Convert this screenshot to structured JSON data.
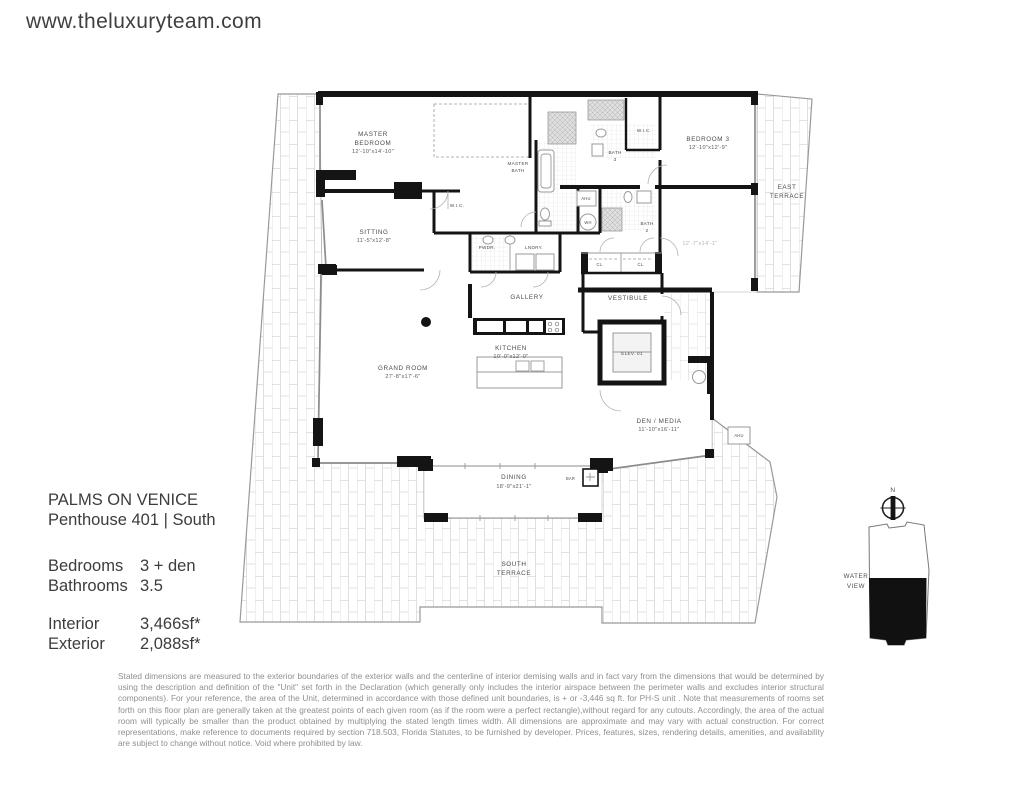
{
  "site": {
    "url": "www.theluxuryteam.com"
  },
  "listing": {
    "title": "PALMS ON VENICE",
    "subtitle": "Penthouse 401 | South",
    "specs": [
      {
        "label": "Bedrooms",
        "value": "3 + den"
      },
      {
        "label": "Bathrooms",
        "value": "3.5"
      },
      {
        "label": "Interior",
        "value": "3,466sf*"
      },
      {
        "label": "Exterior",
        "value": "2,088sf*"
      }
    ]
  },
  "floorplan": {
    "rooms": {
      "master_bedroom": {
        "l1": "MASTER",
        "l2": "BEDROOM",
        "dim": "12'-10\"x14'-10\""
      },
      "sitting": {
        "l1": "SITTING",
        "dim": "11'-5\"x12'-8\""
      },
      "master_wic": {
        "l1": "W.I.C."
      },
      "master_bath": {
        "l1": "MASTER",
        "l2": "BATH"
      },
      "pwdr": {
        "l1": "PWDR."
      },
      "lndry": {
        "l1": "LNDRY."
      },
      "gallery": {
        "l1": "GALLERY"
      },
      "kitchen": {
        "l1": "KITCHEN",
        "dim": "10'-0\"x12'-0\""
      },
      "grand_room": {
        "l1": "GRAND ROOM",
        "dim": "27'-8\"x17'-6\""
      },
      "dining": {
        "l1": "DINING",
        "dim": "18'-9\"x21'-1\""
      },
      "bar": {
        "l1": "BAR"
      },
      "south_terrace": {
        "l1": "SOUTH",
        "l2": "TERRACE"
      },
      "east_terrace": {
        "l1": "EAST",
        "l2": "TERRACE"
      },
      "bedroom3": {
        "l1": "BEDROOM 3",
        "dim": "12'-10\"x12'-9\""
      },
      "bedroom3_wic": {
        "l1": "W.I.C."
      },
      "bath3": {
        "l1": "BATH",
        "l2": "3"
      },
      "bath2": {
        "l1": "BATH",
        "l2": "2"
      },
      "bedroom2": {
        "dim": "12'-7\"x14'-1\""
      },
      "vestibule": {
        "l1": "VESTIBULE"
      },
      "cl_a": {
        "l1": "CL."
      },
      "cl_b": {
        "l1": "CL."
      },
      "elevator": {
        "l1": "ELEV. 01"
      },
      "den_media": {
        "l1": "DEN / MEDIA",
        "dim": "11'-10\"x16'-11\""
      },
      "ahu_a": {
        "l1": "AHU"
      },
      "wh": {
        "l1": "WH"
      },
      "ahu_b": {
        "l1": "AHU"
      }
    },
    "compass_north": "N",
    "keyplan_caption": {
      "l1": "WATER",
      "l2": "VIEW"
    }
  },
  "disclaimer": "Stated dimensions are measured to the exterior boundaries of the exterior walls and the centerline of interior demising walls and in fact vary from the dimensions that would be determined by using the description and definition of the \"Unit\" set forth in the Declaration (which generally only includes the interior airspace between the perimeter walls and excludes interior structural components). For your reference, the area of the Unit, determined in accordance with those defined unit boundaries, is + or -3,446 sq ft. for PH-S unit . Note that measurements of rooms set forth on this floor plan are generally taken at the greatest points of each given room (as if the room were a perfect rectangle),without regard for any cutouts. Accordingly, the area of the actual room will typically be smaller than the product obtained by multiplying the stated length times width. All dimensions are approximate and may vary with actual construction. For correct representations, make reference to documents required by section 718.503, Florida Statutes, to be furnished by developer. Prices, features, sizes, rendering details, amenities, and availability are subject to change without notice. Void where prohibited by law."
}
